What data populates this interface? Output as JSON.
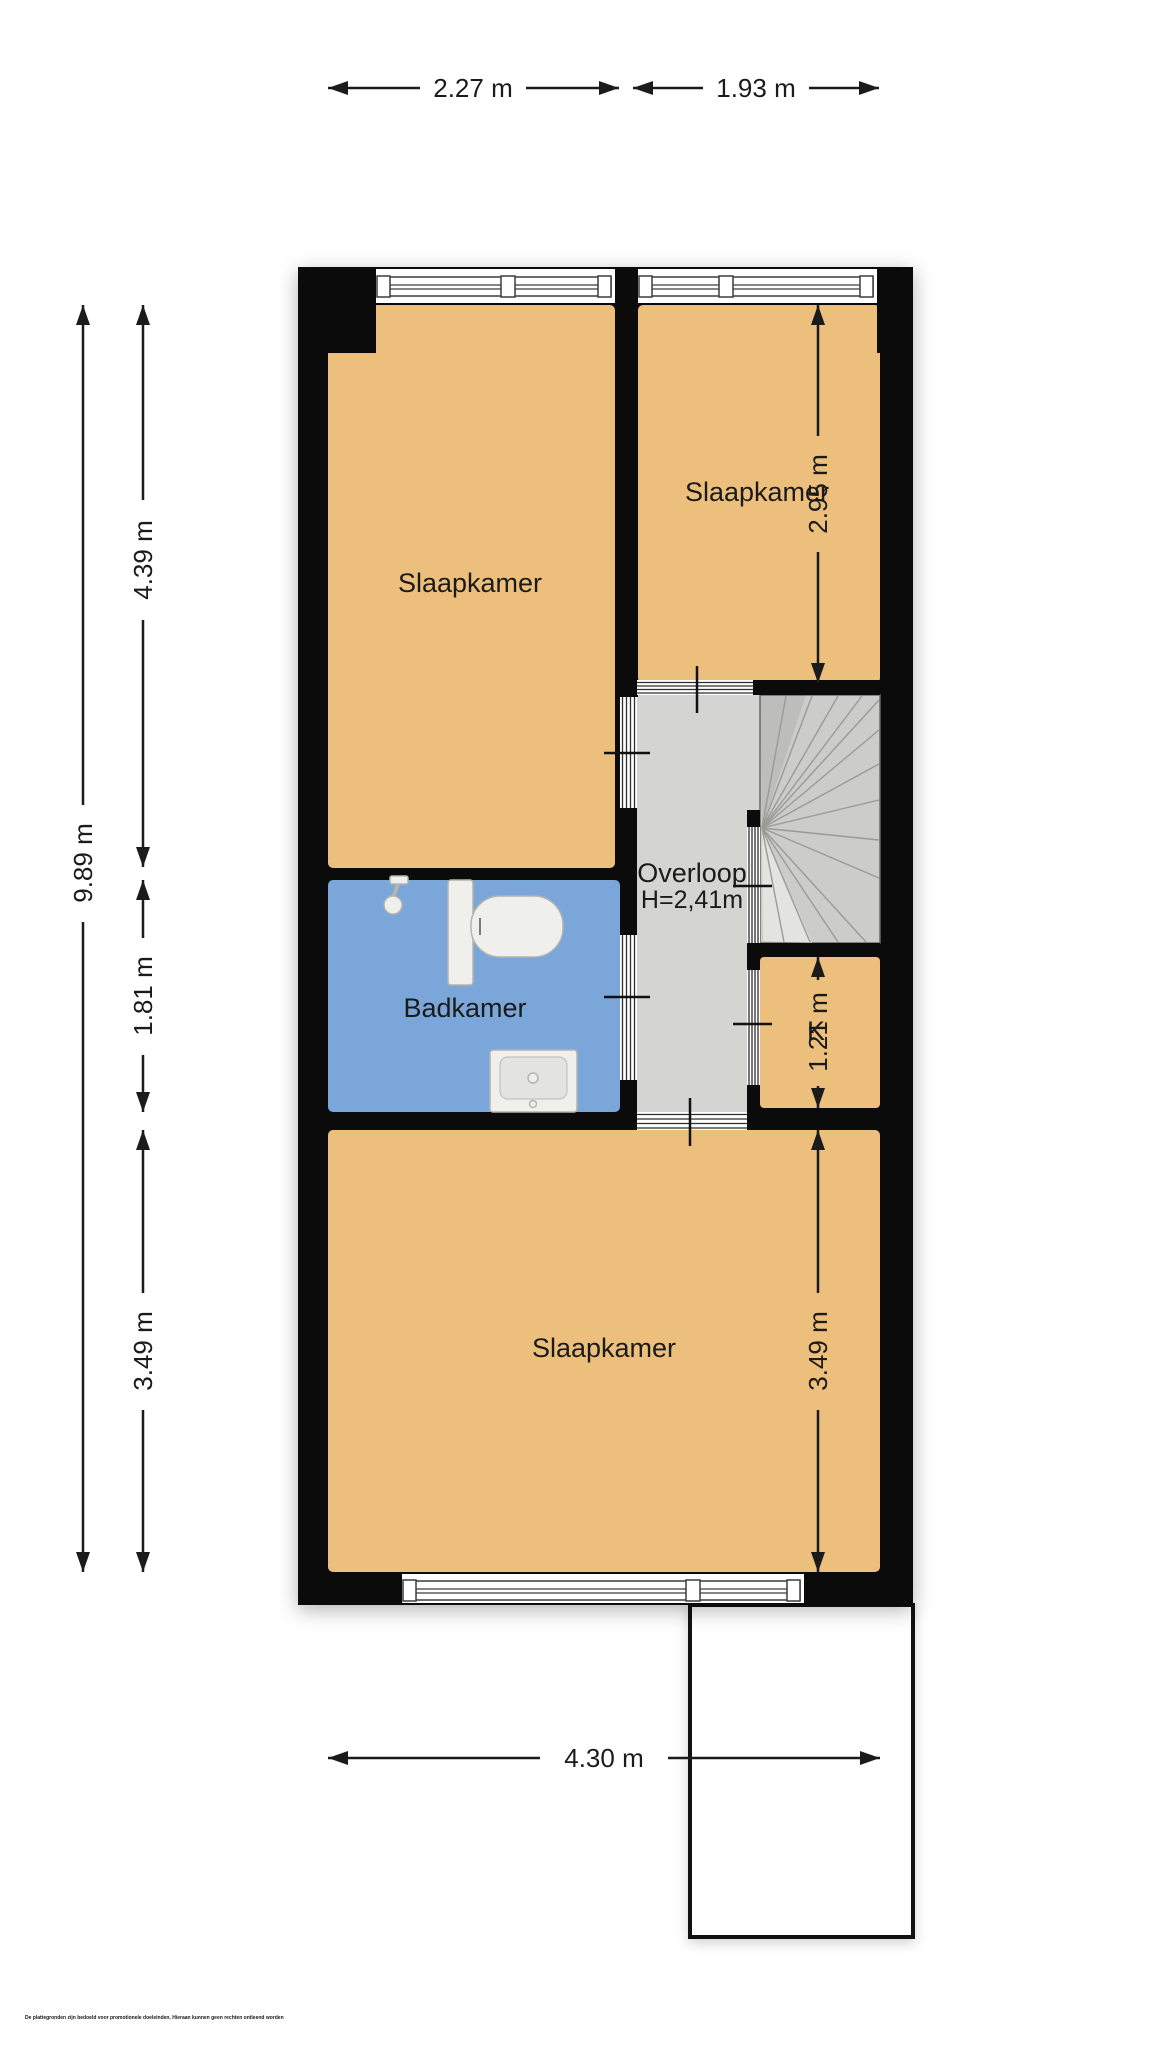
{
  "plan": {
    "rooms": {
      "bedroom_top_left": "Slaapkamer",
      "bedroom_top_right": "Slaapkamer",
      "landing": "Overloop",
      "landing_height": "H=2,41m",
      "bathroom": "Badkamer",
      "closet": "K",
      "bedroom_bottom": "Slaapkamer"
    },
    "dimensions": {
      "top_left_width": "2.27 m",
      "top_right_width": "1.93 m",
      "total_height": "9.89 m",
      "left_upper": "4.39 m",
      "left_middle": "1.81 m",
      "left_lower": "3.49 m",
      "right_upper": "2.95 m",
      "right_middle": "1.21 m",
      "right_lower": "3.49 m",
      "bottom_width": "4.30 m"
    },
    "colors": {
      "room": "#ECBF7C",
      "bathroom": "#7BA6D9",
      "hall": "#D4D4D2",
      "stairs": "#CCCCCA",
      "wall": "#0B0B0B",
      "label": "#1B1B1B"
    },
    "disclaimer": "De plattegronden zijn bedoeld voor promotionele doeleinden. Hieraan kunnen geen rechten ontleend worden"
  }
}
